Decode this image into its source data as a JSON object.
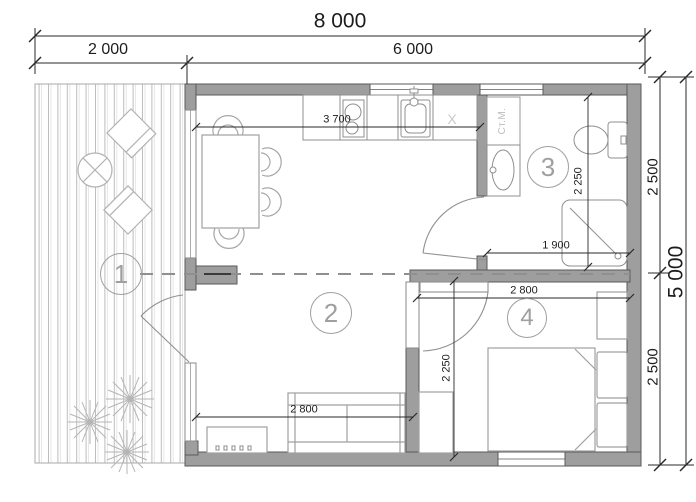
{
  "colors": {
    "wall": "#9e9e9e",
    "wall-edge": "#5a5a5a",
    "dim": "#1c1c1c",
    "light": "#9f9f9f",
    "fixture": "#8f8f8f"
  },
  "dimensions": {
    "total_width": "8 000",
    "terrace_width": "2 000",
    "house_width": "6 000",
    "total_depth": "5 000",
    "depth_upper": "2 500",
    "depth_lower": "2 500",
    "kitchen_wall_width": "3 700",
    "bathroom_depth": "2 250",
    "bathroom_width": "1 900",
    "bedroom_width": "2 800",
    "bedroom_depth": "2 250",
    "living_width": "2 800"
  },
  "rooms": {
    "terrace": "1",
    "living": "2",
    "bathroom": "3",
    "bedroom": "4"
  },
  "labels": {
    "washing_machine": "Ст.М.",
    "kitchen_mark": "X"
  }
}
